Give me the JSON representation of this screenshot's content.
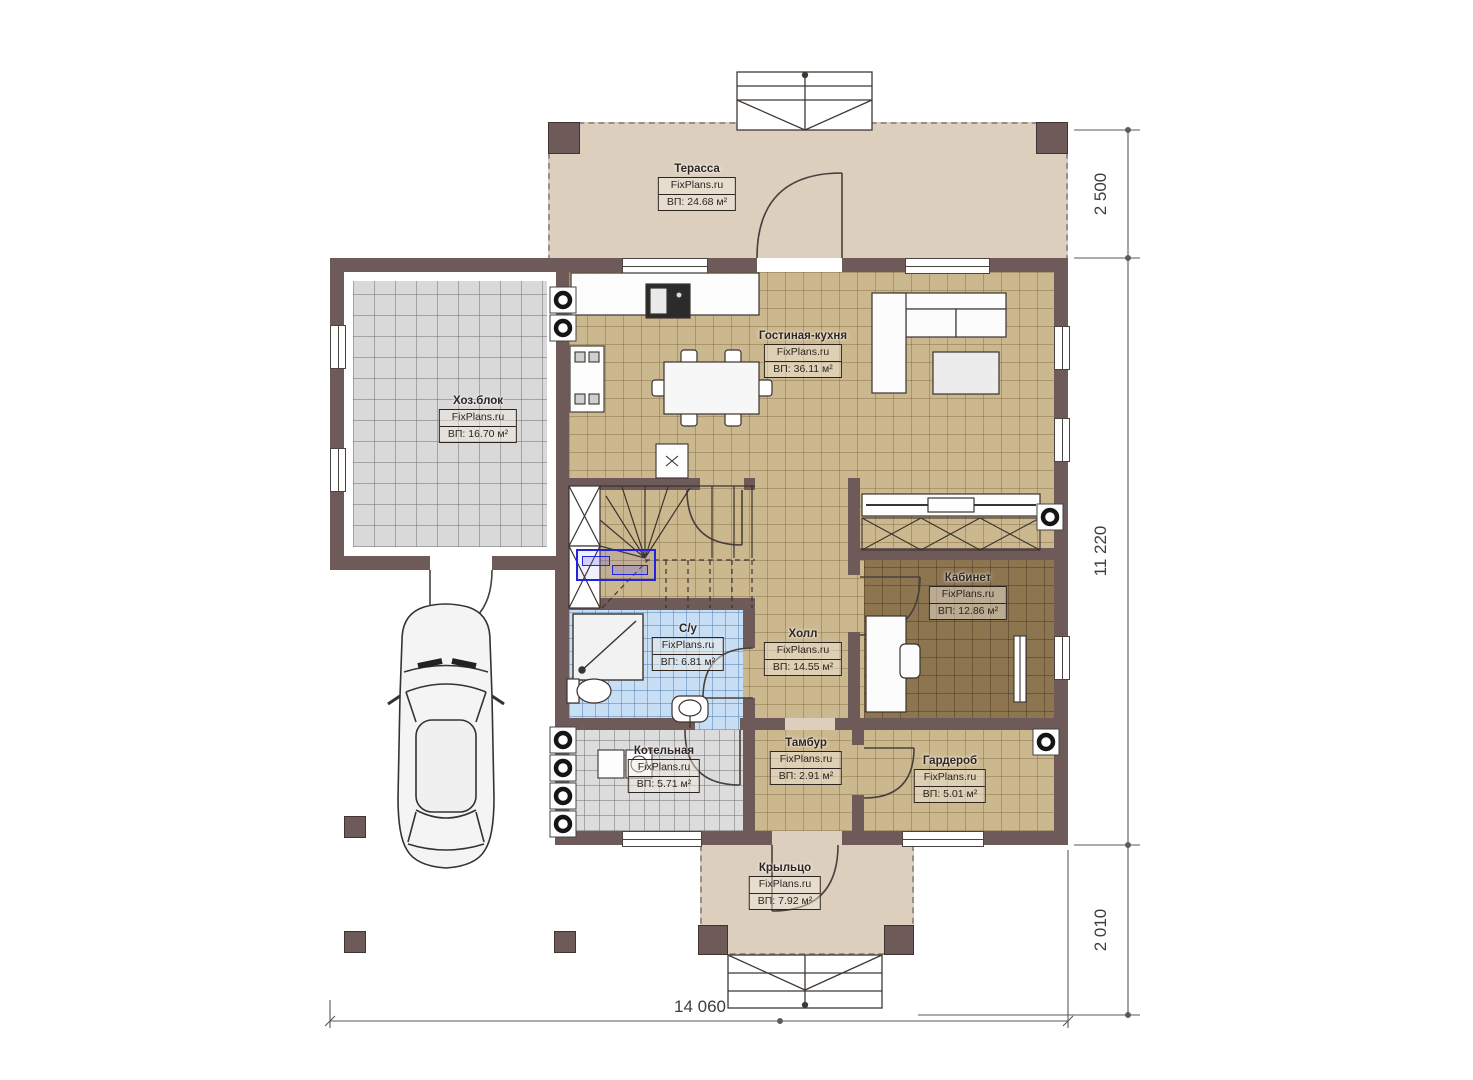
{
  "plan": {
    "watermark": "FixPlans.ru",
    "rooms": [
      {
        "key": "terrace",
        "name": "Терасса",
        "area": "ВП: 24.68 м²"
      },
      {
        "key": "living_kitchen",
        "name": "Гостиная-кухня",
        "area": "ВП: 36.11 м²"
      },
      {
        "key": "utility",
        "name": "Хоз.блок",
        "area": "ВП: 16.70 м²"
      },
      {
        "key": "study",
        "name": "Кабинет",
        "area": "ВП: 12.86 м²"
      },
      {
        "key": "bathroom",
        "name": "С/у",
        "area": "ВП: 6.81 м²"
      },
      {
        "key": "hall",
        "name": "Холл",
        "area": "ВП: 14.55 м²"
      },
      {
        "key": "boiler",
        "name": "Котельная",
        "area": "ВП: 5.71 м²"
      },
      {
        "key": "vestibule",
        "name": "Тамбур",
        "area": "ВП: 2.91 м²"
      },
      {
        "key": "wardrobe",
        "name": "Гардероб",
        "area": "ВП: 5.01 м²"
      },
      {
        "key": "porch",
        "name": "Крыльцо",
        "area": "ВП: 7.92 м²"
      }
    ],
    "dimensions": {
      "right_top": "2 500",
      "right_middle": "11 220",
      "right_bottom": "2 010",
      "bottom": "14 060"
    },
    "colors": {
      "wall": "#6e5a58",
      "floor_tan": "#ccb88e",
      "floor_gray": "#d9d9d9",
      "floor_blue": "#c7def4",
      "floor_study": "#8d7550",
      "floor_beige": "#dccfbd",
      "selection": "#2323dd"
    }
  }
}
